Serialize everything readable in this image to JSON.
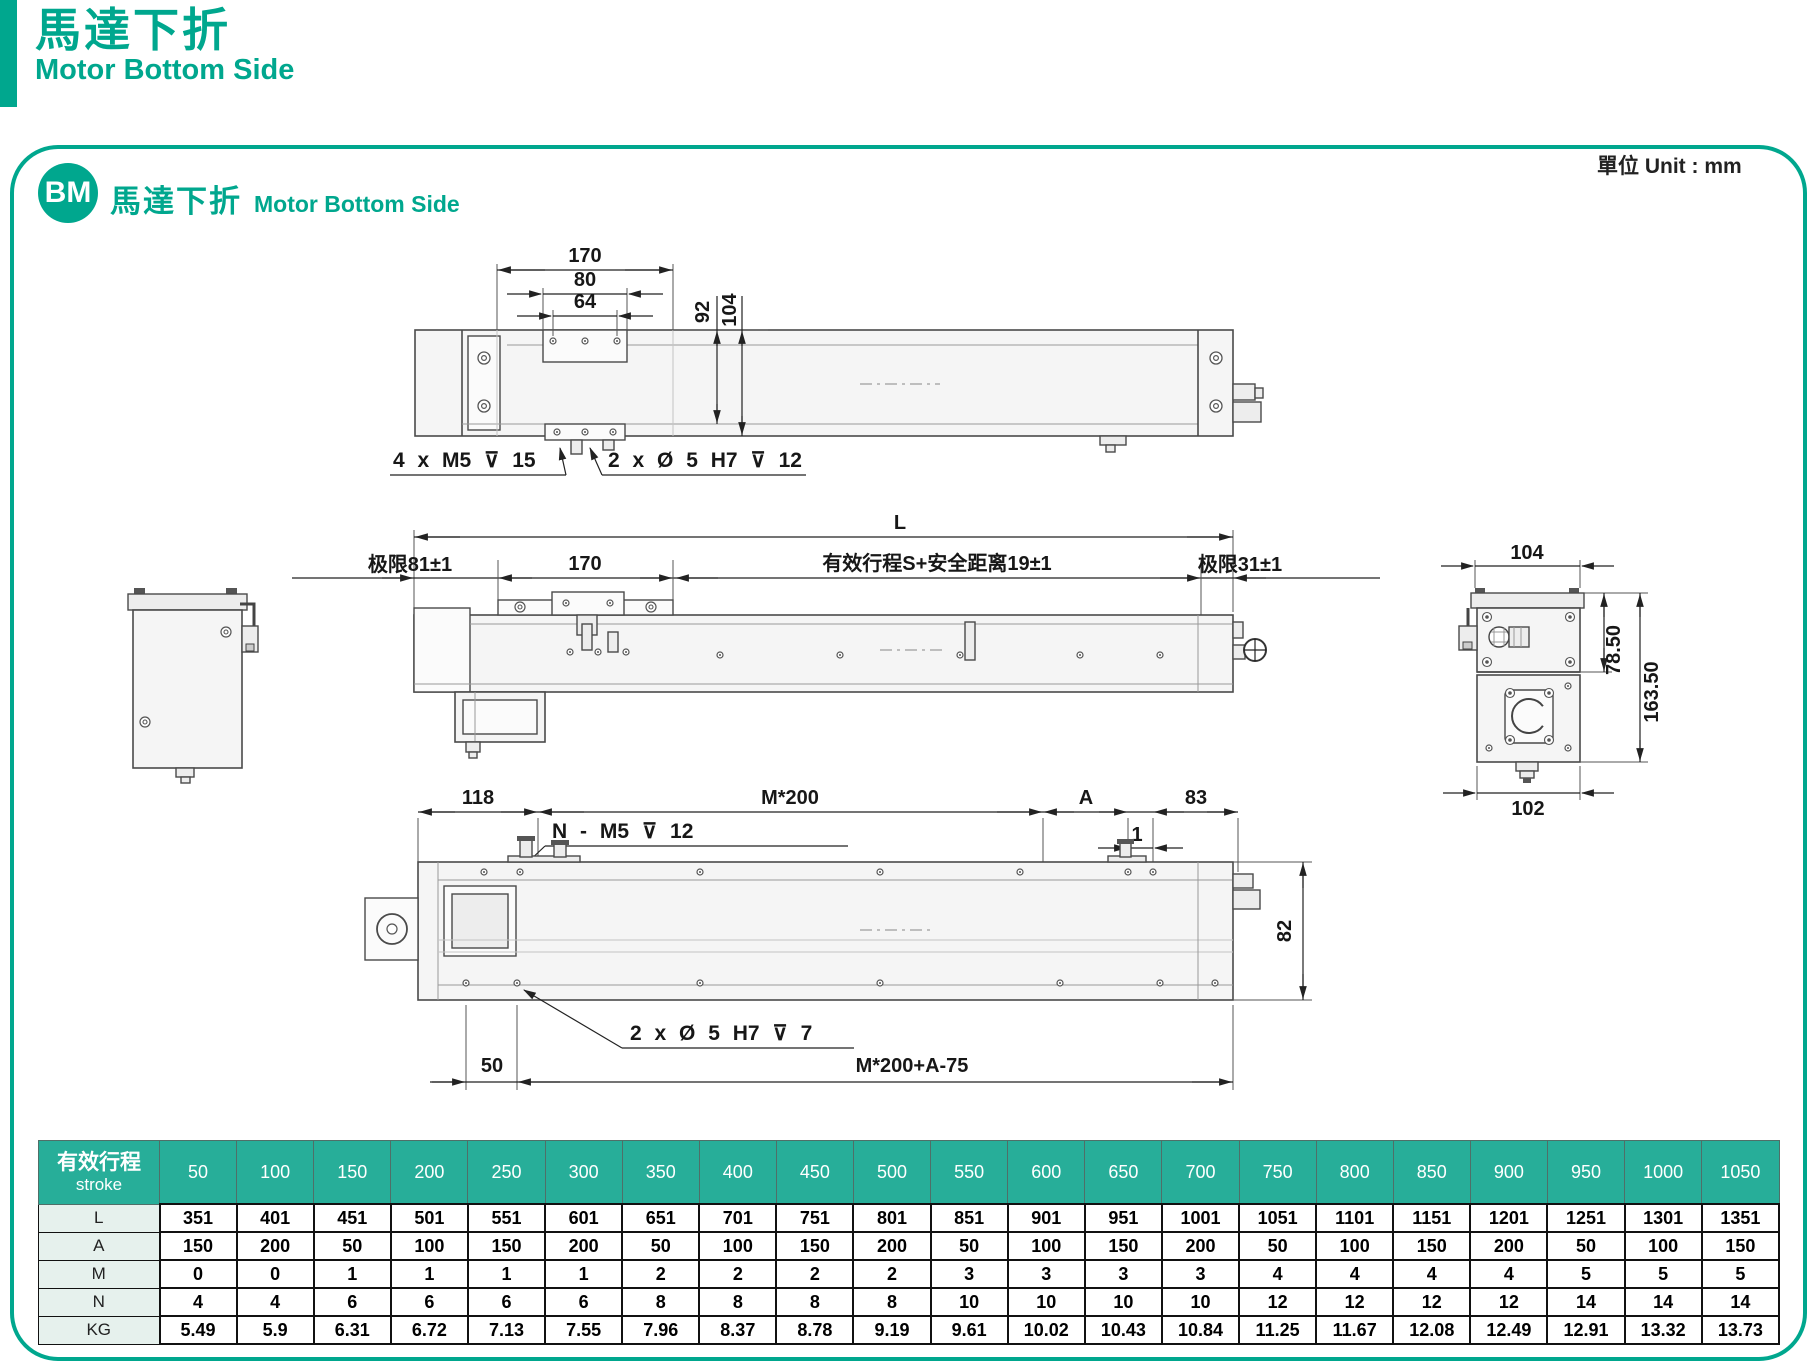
{
  "page_header": {
    "title_zh": "馬達下折",
    "title_en": "Motor Bottom Side"
  },
  "panel": {
    "badge": "BM",
    "section_title_zh": "馬達下折",
    "section_title_en": "Motor Bottom Side",
    "unit_label": "單位 Unit : mm"
  },
  "top_view": {
    "dim_170": "170",
    "dim_80": "80",
    "dim_64": "64",
    "dim_92": "92",
    "dim_104": "104",
    "callout_m5": "4 x M5 ⊽ 15",
    "callout_dowel": "2 x Ø 5 H7 ⊽ 12"
  },
  "front_view": {
    "dim_L": "L",
    "dim_limit_left": "极限81±1",
    "dim_170": "170",
    "dim_stroke": "有效行程S+安全距离19±1",
    "dim_limit_right": "极限31±1"
  },
  "end_view": {
    "dim_104": "104",
    "dim_78_5": "78.50",
    "dim_163_5": "163.50",
    "dim_102": "102"
  },
  "bottom_view": {
    "dim_118": "118",
    "dim_m200": "M*200",
    "dim_A": "A",
    "dim_83": "83",
    "dim_1": "1",
    "dim_82": "82",
    "dim_50": "50",
    "callout_n_m5": "N - M5 ⊽ 12",
    "callout_dowel": "2 x Ø 5 H7 ⊽ 7",
    "dim_m200a": "M*200+A-75"
  },
  "table": {
    "header_zh": "有效行程",
    "header_en": "stroke",
    "strokes": [
      "50",
      "100",
      "150",
      "200",
      "250",
      "300",
      "350",
      "400",
      "450",
      "500",
      "550",
      "600",
      "650",
      "700",
      "750",
      "800",
      "850",
      "900",
      "950",
      "1000",
      "1050"
    ],
    "rows": [
      {
        "label": "L",
        "values": [
          "351",
          "401",
          "451",
          "501",
          "551",
          "601",
          "651",
          "701",
          "751",
          "801",
          "851",
          "901",
          "951",
          "1001",
          "1051",
          "1101",
          "1151",
          "1201",
          "1251",
          "1301",
          "1351"
        ]
      },
      {
        "label": "A",
        "values": [
          "150",
          "200",
          "50",
          "100",
          "150",
          "200",
          "50",
          "100",
          "150",
          "200",
          "50",
          "100",
          "150",
          "200",
          "50",
          "100",
          "150",
          "200",
          "50",
          "100",
          "150"
        ]
      },
      {
        "label": "M",
        "values": [
          "0",
          "0",
          "1",
          "1",
          "1",
          "1",
          "2",
          "2",
          "2",
          "2",
          "3",
          "3",
          "3",
          "3",
          "4",
          "4",
          "4",
          "4",
          "5",
          "5",
          "5"
        ]
      },
      {
        "label": "N",
        "values": [
          "4",
          "4",
          "6",
          "6",
          "6",
          "6",
          "8",
          "8",
          "8",
          "8",
          "10",
          "10",
          "10",
          "10",
          "12",
          "12",
          "12",
          "12",
          "14",
          "14",
          "14"
        ]
      },
      {
        "label": "KG",
        "values": [
          "5.49",
          "5.9",
          "6.31",
          "6.72",
          "7.13",
          "7.55",
          "7.96",
          "8.37",
          "8.78",
          "9.19",
          "9.61",
          "10.02",
          "10.43",
          "10.84",
          "11.25",
          "11.67",
          "12.08",
          "12.49",
          "12.91",
          "13.32",
          "13.73"
        ]
      }
    ]
  },
  "colors": {
    "teal": "#00a78e",
    "table_header": "#27ae99",
    "row_label_bg": "#e6f1ed"
  }
}
